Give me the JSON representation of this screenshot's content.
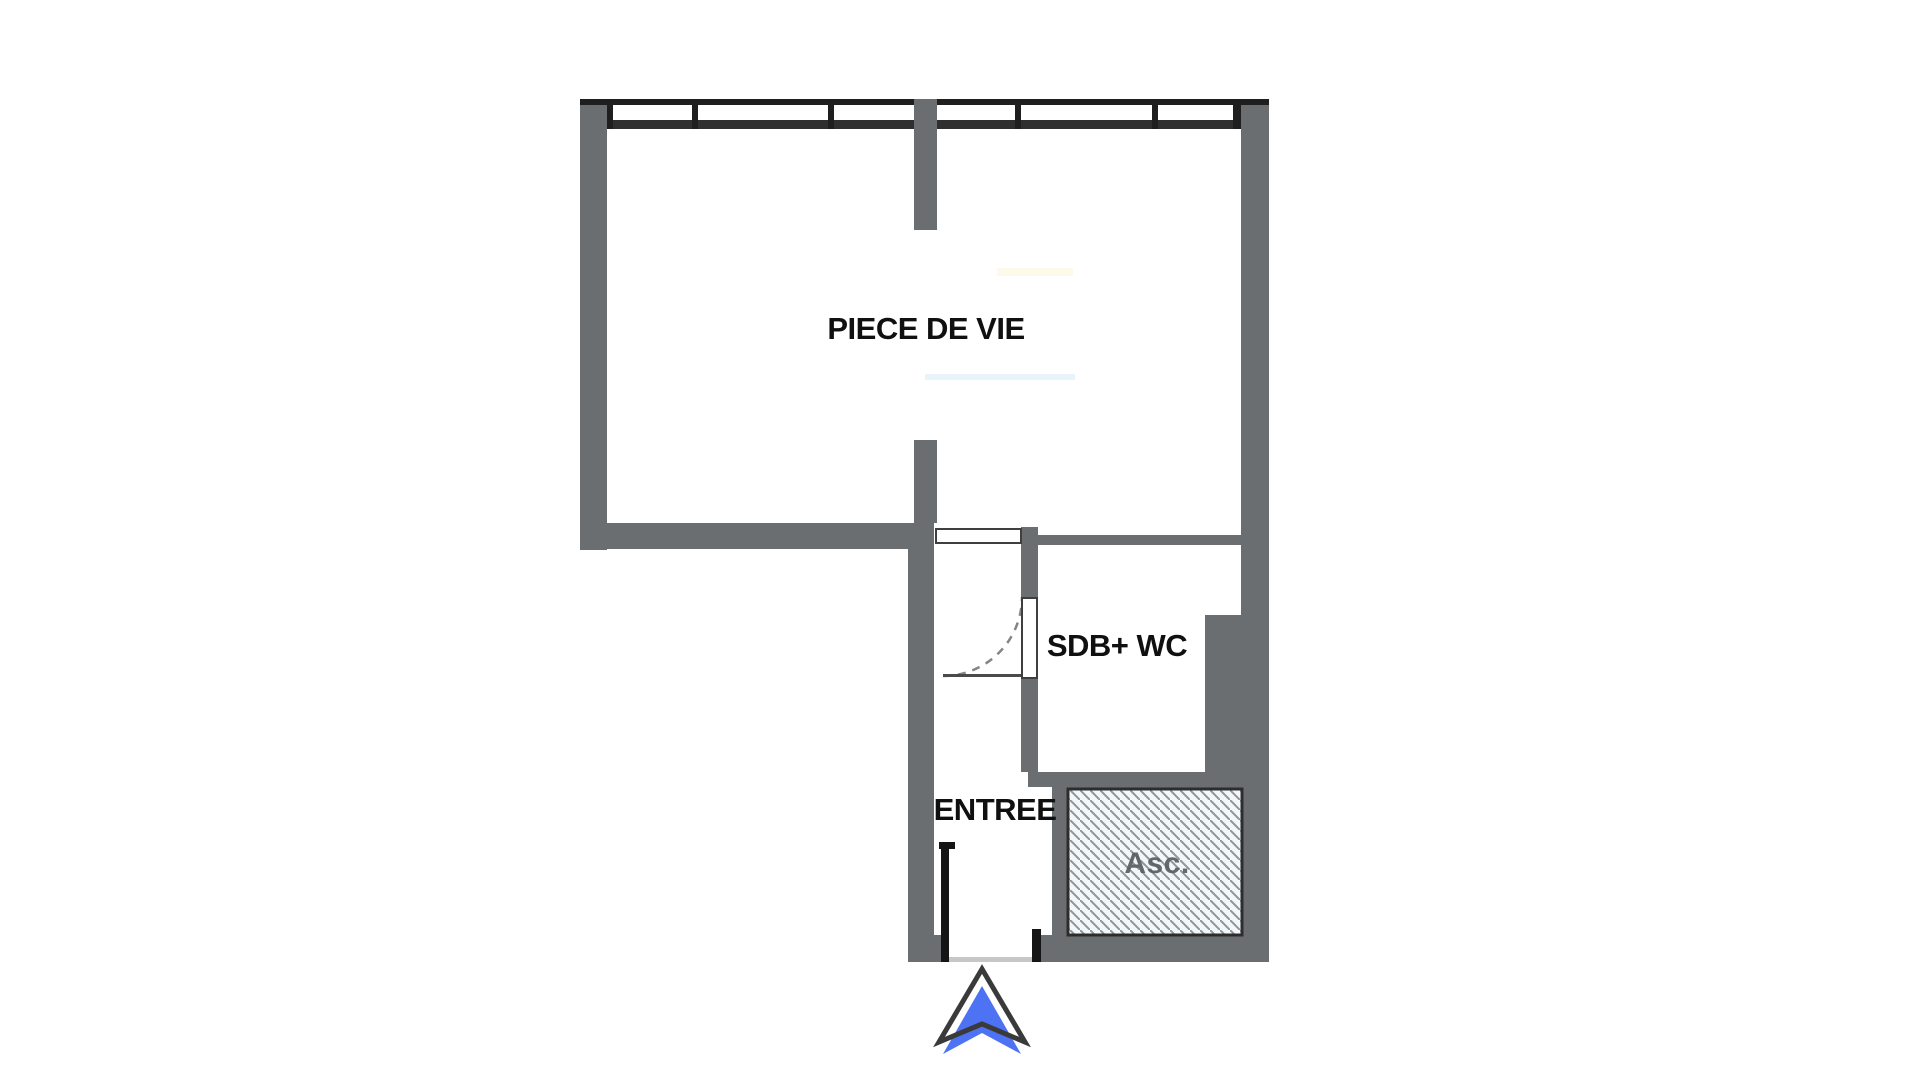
{
  "plan": {
    "title": "studio-apartment-floor-plan",
    "rooms": [
      {
        "id": "living",
        "label": "PIECE DE VIE"
      },
      {
        "id": "bathroom",
        "label": "SDB+ WC"
      },
      {
        "id": "entry",
        "label": "ENTREE"
      },
      {
        "id": "elevator",
        "label": "Asc."
      }
    ],
    "colors": {
      "background": "#ffffff",
      "wall_gray": "#6a6e70",
      "window_line_black": "#1f1f1f",
      "window_inner_band": "#2f2f2f",
      "door_outline": "#3f3f3f",
      "door_swing_arc": "#858585",
      "elevator_hatch_line": "#8d969b",
      "elevator_hatch_fill": "#f3f7f8",
      "elevator_box_border": "#2d2d2d",
      "arrow_blue": "#4e72f4",
      "arrow_outline": "#3a3a3a",
      "room_label_text": "#101010",
      "elevator_label_text": "#5a5f63"
    }
  }
}
